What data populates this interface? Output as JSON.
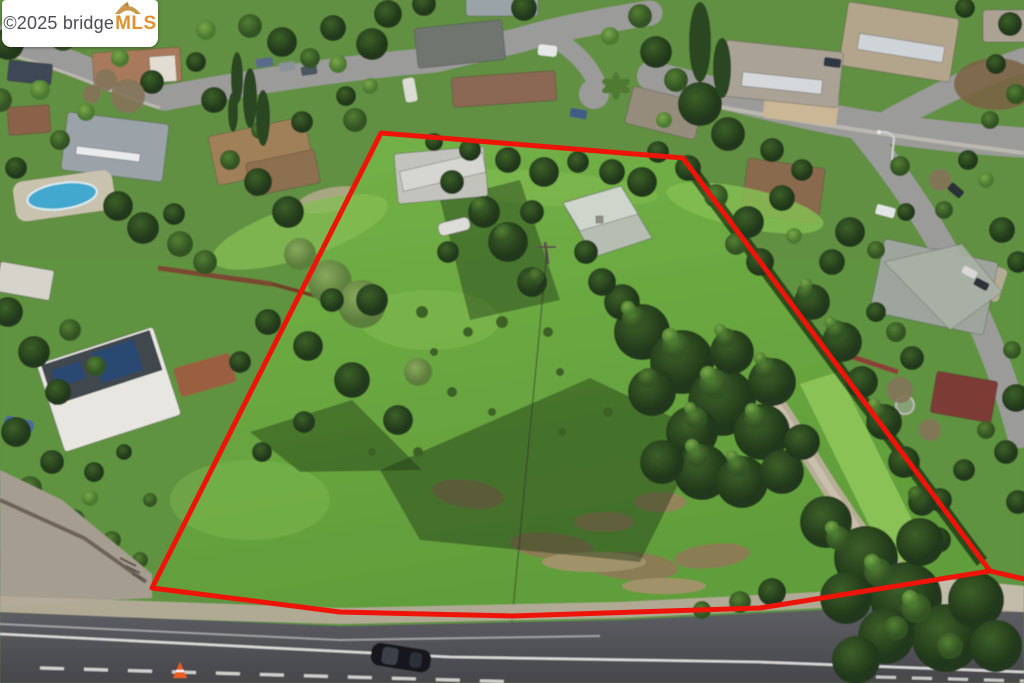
{
  "watermark": {
    "copyright": "©2025 ",
    "brand": "bridge",
    "brand_suffix": "MLS",
    "text_color": "#4b4b55",
    "suffix_color": "#df912e",
    "badge_background": "#ffffff",
    "icon": "bridge-arch-icon"
  },
  "scene": {
    "type": "aerial-photograph",
    "subject": "Drone aerial view of a large grassy hillside parcel outlined in red within a suburban neighborhood, road along bottom edge",
    "boundary": {
      "color": "#ee1409",
      "points": "381,133 683,158 990,571 760,608 512,616 340,612 152,588 381,133",
      "tail_points": "990,571 1024,579"
    },
    "colors": {
      "field_base": "#5f9340",
      "meadow": "#6cab41",
      "asphalt": "#54555a",
      "neighborhood_street": "#9b9b99",
      "pool": "#43a8cd",
      "lane_marking": "#e6e6e3",
      "car_body": "#17191d",
      "traffic_cone": "#e8611f"
    }
  }
}
